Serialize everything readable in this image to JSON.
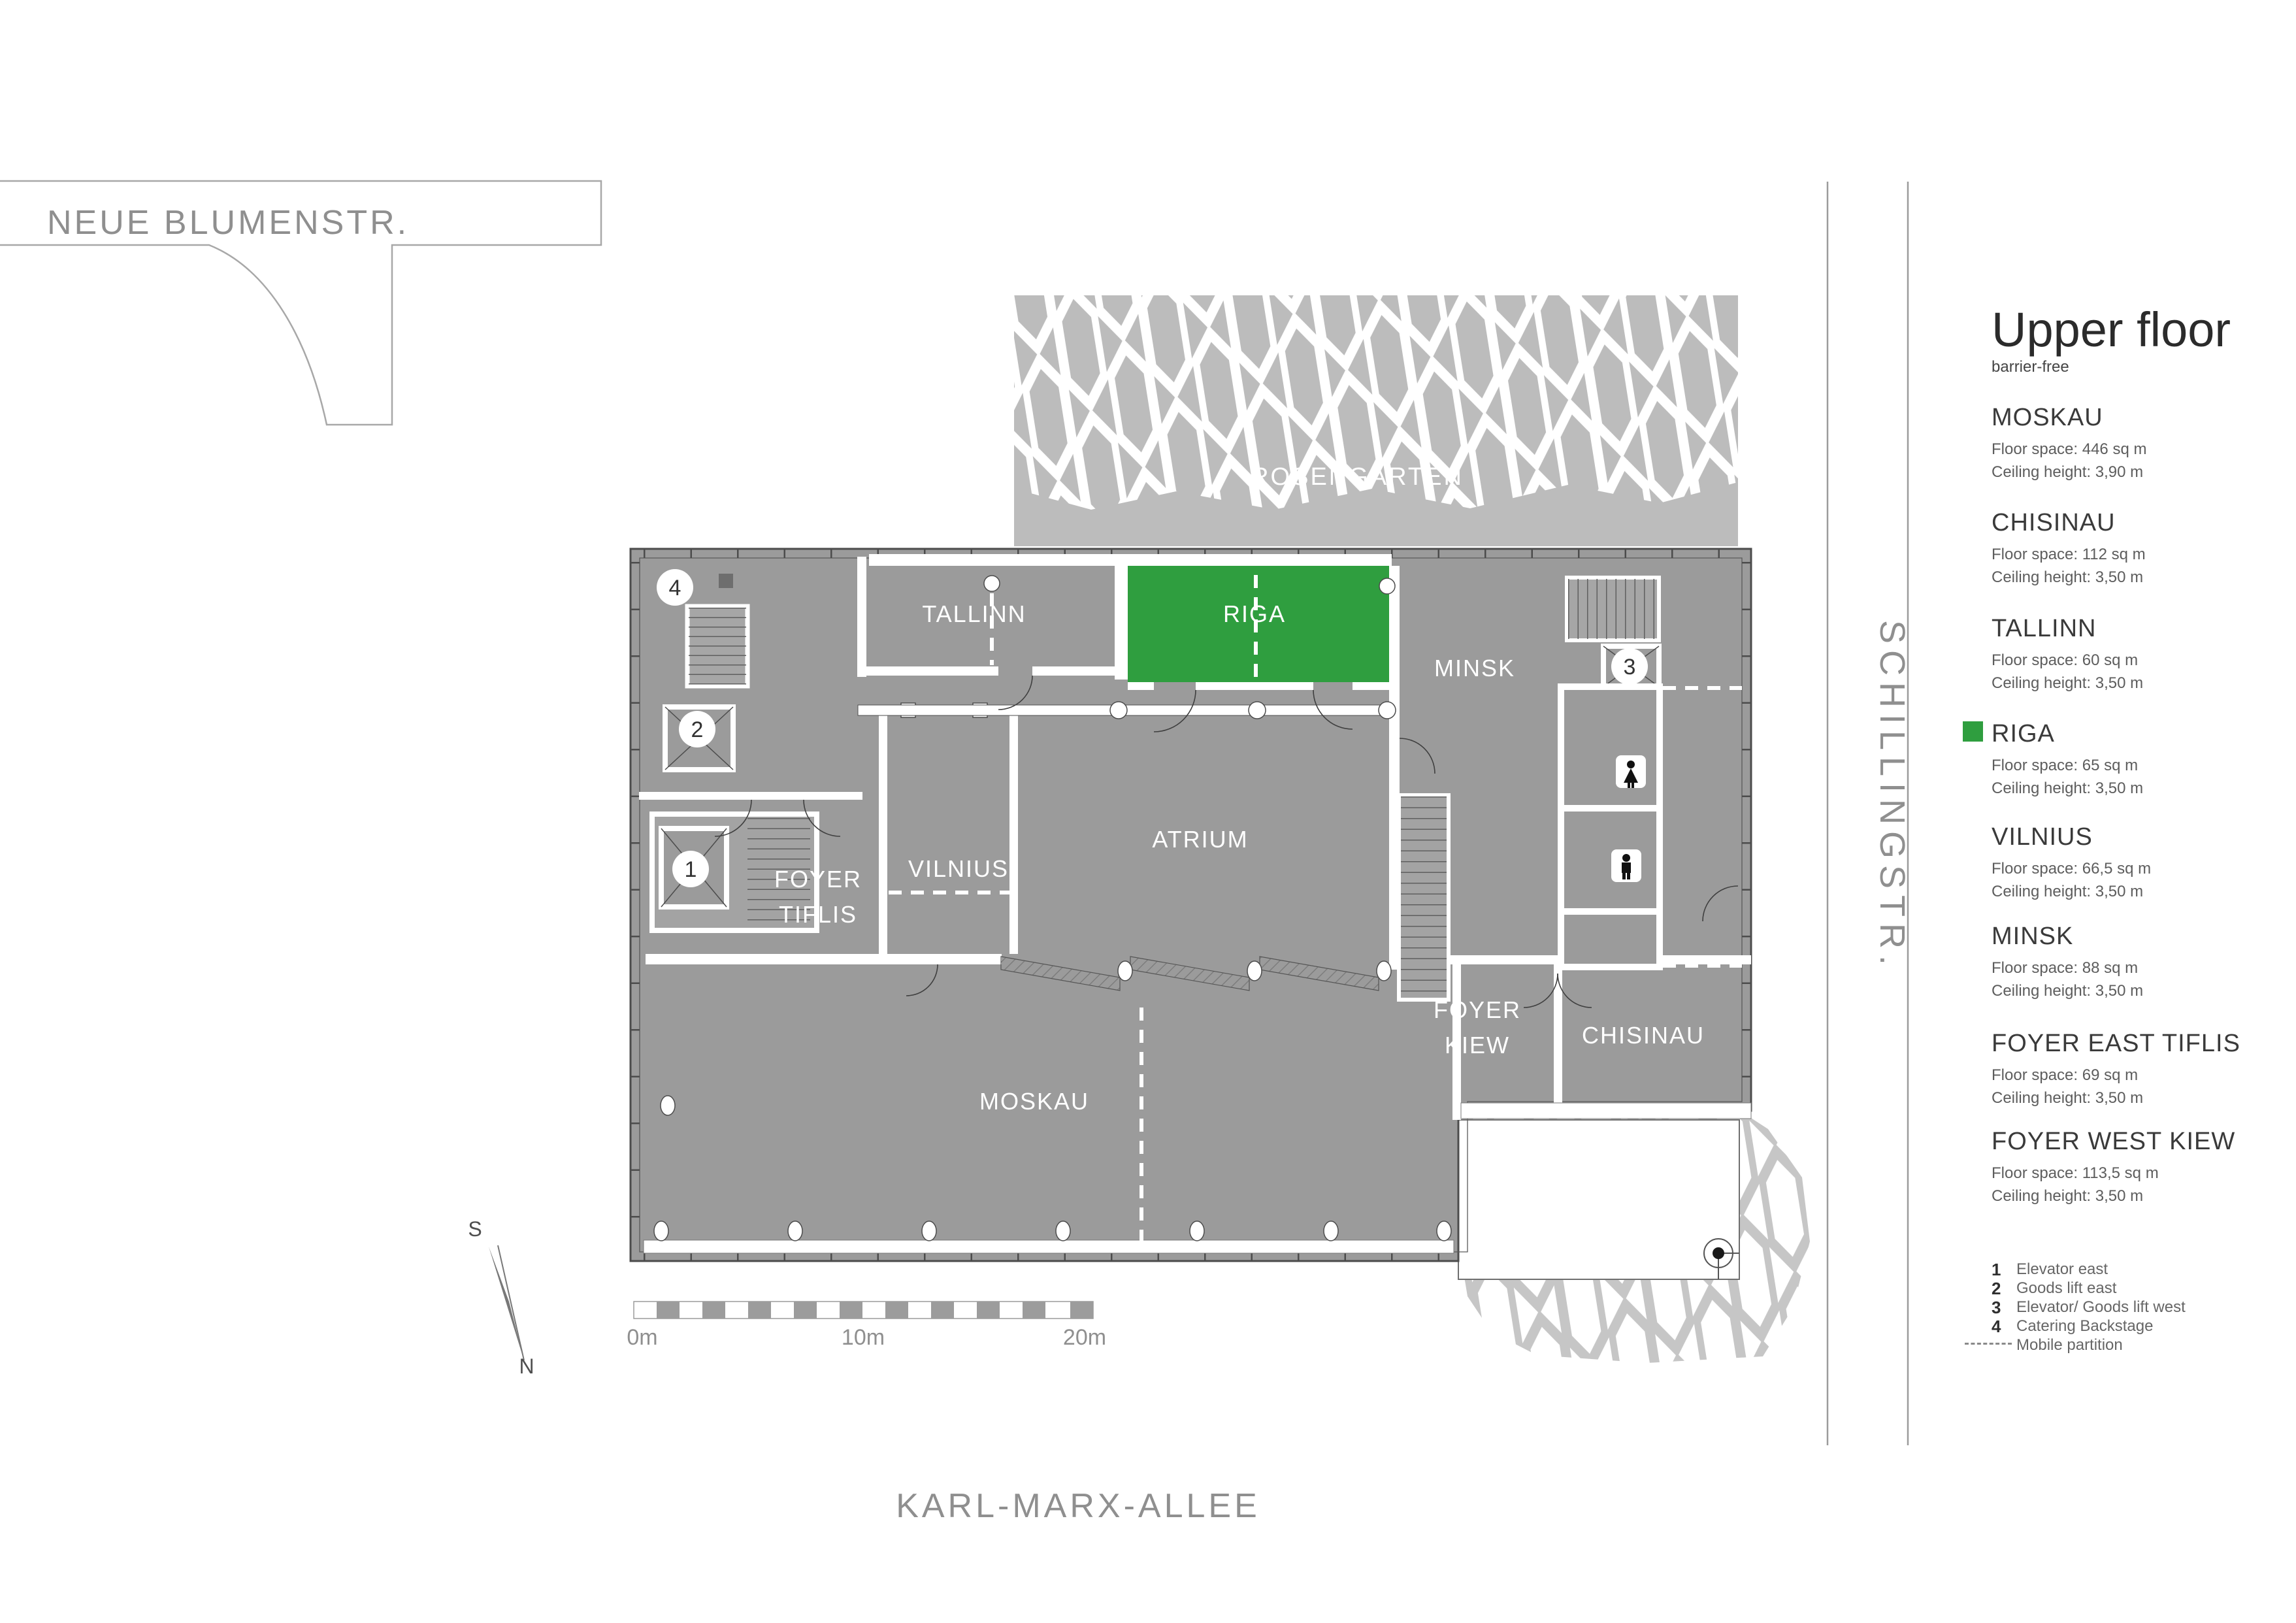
{
  "streets": {
    "top_left": "NEUE BLUMENSTR.",
    "right": "SCHILLINGSTR.",
    "bottom": "KARL-MARX-ALLEE"
  },
  "header": {
    "title": "Upper floor",
    "subtitle": "barrier-free"
  },
  "plan": {
    "labels": {
      "rosengarten": "ROSENGARTEN",
      "tallinn": "TALLINN",
      "riga": "RIGA",
      "minsk": "MINSK",
      "atrium": "ATRIUM",
      "vilnius": "VILNIUS",
      "foyer_tiflis_line1": "FOYER",
      "foyer_tiflis_line2": "TIFLIS",
      "moskau": "MOSKAU",
      "foyer_kiew_line1": "FOYER",
      "foyer_kiew_line2": "KIEW",
      "chisinau": "CHISINAU"
    },
    "markers": {
      "elevator_east": "1",
      "goods_lift_east": "2",
      "elevator_goods_lift_west": "3",
      "catering_backstage": "4"
    },
    "compass": {
      "south": "S",
      "north": "N"
    },
    "scale": {
      "zero": "0m",
      "ten": "10m",
      "twenty": "20m"
    },
    "colors": {
      "building_gray": "#9b9b9b",
      "garden_gray": "#bcbcbc",
      "highlight_green": "#2f9e3f",
      "wall_line": "#4c4c4c"
    }
  },
  "sidebar": {
    "rooms": [
      {
        "name": "MOSKAU",
        "floor_space": "Floor space: 446 sq m",
        "ceiling_height": "Ceiling height: 3,90 m"
      },
      {
        "name": "CHISINAU",
        "floor_space": "Floor space: 112 sq m",
        "ceiling_height": "Ceiling height: 3,50 m"
      },
      {
        "name": "TALLINN",
        "floor_space": "Floor space: 60 sq m",
        "ceiling_height": "Ceiling height: 3,50 m"
      },
      {
        "name": "RIGA",
        "highlighted": true,
        "floor_space": "Floor space: 65 sq m",
        "ceiling_height": "Ceiling height: 3,50 m"
      },
      {
        "name": "VILNIUS",
        "floor_space": "Floor space: 66,5 sq m",
        "ceiling_height": "Ceiling height: 3,50 m"
      },
      {
        "name": "MINSK",
        "floor_space": "Floor space: 88 sq m",
        "ceiling_height": "Ceiling height: 3,50 m"
      },
      {
        "name": "FOYER EAST TIFLIS",
        "floor_space": "Floor space: 69 sq m",
        "ceiling_height": "Ceiling height: 3,50 m"
      },
      {
        "name": "FOYER WEST KIEW",
        "floor_space": "Floor space: 113,5 sq m",
        "ceiling_height": "Ceiling height: 3,50 m"
      }
    ],
    "legend": [
      {
        "num": "1",
        "label": "Elevator east"
      },
      {
        "num": "2",
        "label": "Goods lift east"
      },
      {
        "num": "3",
        "label": "Elevator/ Goods lift west"
      },
      {
        "num": "4",
        "label": "Catering Backstage"
      },
      {
        "num": "",
        "label": "Mobile partition",
        "dashed": true
      }
    ]
  }
}
